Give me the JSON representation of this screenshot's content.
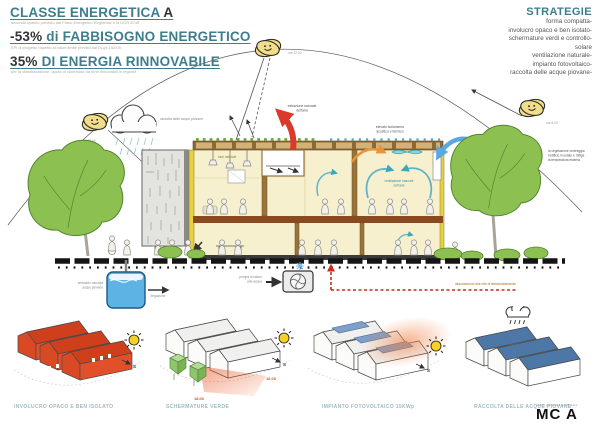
{
  "colors": {
    "accent": "#3e7d8c",
    "orange_house": "#e2502a",
    "blue_roof": "#5b87b8",
    "tree_green": "#8cc152",
    "water_blue": "#5db4e4",
    "hot_red": "#d93a2b",
    "air_teal": "#3aa8b8"
  },
  "header": {
    "line1_main": "CLASSE ENERGETICA",
    "line1_accent": "A",
    "line1_sub": "secondo quanto previsto dal Piano Energetico Regionale e la DGR 8745",
    "line2_num": "-53%",
    "line2_rest": "di FABBISOGNO ENERGETICO",
    "line2_sub": "EPi di progetto rispetto ai valori limite previsti dal DLgs 192/05",
    "line3_num": "35%",
    "line3_rest": "DI ENERGIA RINNOVABILE",
    "line3_sub": "per la climatizzazione, quota di contributo da fonti rinnovabili in regione"
  },
  "strategie": {
    "title": "STRATEGIE",
    "items": [
      "forma compatta-",
      "involucro opaco e ben isolato-",
      "schermature verdi e controllo-",
      "solare",
      "ventilazione naturale-",
      "impianto fotovoltaico-",
      "raccolta delle acque piovane-"
    ]
  },
  "scene": {
    "sun_time_left": "ore 18.00",
    "sun_time_top": "ore 12.00",
    "sun_time_right": "ore 8.00",
    "rain": "raccolta delle acque piovane",
    "extraction1": "estrazione naturale",
    "extraction2": "dell'aria",
    "roof1": "elevato isolamento",
    "roof2": "acustico e termico",
    "daylight": "luce naturale",
    "vent1": "ventilazione naturale",
    "vent2": "dell'aria",
    "tree1": "la vegetazione ombreggia",
    "tree2": "l'edificio in estate e mitiga",
    "tree3": "la temperatura esterna",
    "tank1": "serbatoio raccolta",
    "tank2": "acque piovane",
    "irrigation": "irrigazione",
    "pump1": "pompa di calore",
    "pump2": "aria-acqua",
    "district": "allacciamento alla rete di teleriscaldamento"
  },
  "compass": "S",
  "diagrams": [
    {
      "label": "INVOLUCRO OPACO E BEN ISOLATO"
    },
    {
      "label": "SCHERMATURE VERDE",
      "time_a": "18.00",
      "time_b": "16.00"
    },
    {
      "label": "IMPIANTO FOTOVOLTAICO 15KWp"
    },
    {
      "label": "RACCOLTA DELLE ACQUE PIOVANE"
    }
  ],
  "logo": {
    "small": "mario cucinella architects",
    "main": "MC A"
  }
}
